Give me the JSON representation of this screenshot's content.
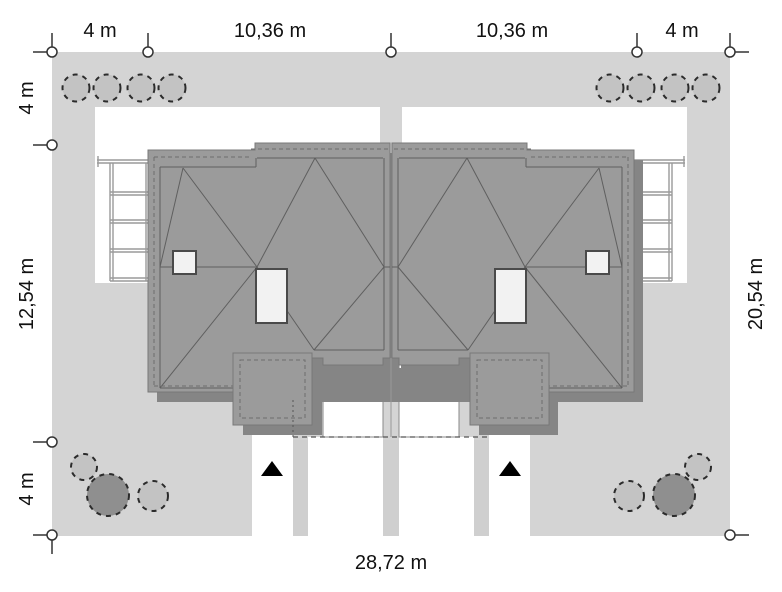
{
  "drawing": {
    "type": "site-plan",
    "description": "Roof-view plot plan of a twin (duplex) house with dimension chains, driveways, entrance arrows and garden shrubs",
    "dimensions": {
      "top": [
        "4 m",
        "10,36 m",
        "10,36 m",
        "4 m"
      ],
      "left": [
        "4 m",
        "12,54 m",
        "4 m"
      ],
      "right": [
        "20,54 m"
      ],
      "bottom": [
        "28,72 m"
      ]
    },
    "icons": {
      "dimension_marker": "survey-point-circle",
      "entrance_arrow": "black-triangle-up",
      "tree": "scalloped-shrub-circle"
    },
    "colors": {
      "plot": "#d4d4d4",
      "paving": "#ffffff",
      "path_strip": "#cfcfcf",
      "roof": "#9b9b9b",
      "roof_shadow": "#858585",
      "roof_line": "#5f5f5f",
      "roof_edge": "#787878",
      "dashed_line": "#6e6e6e",
      "chimney": "#f2f2f2",
      "chimney_border": "#4a4a4a",
      "forecourt_line": "#8a8a8a",
      "pergola_line": "#9a9a9a",
      "tree_light": "#c3c3c3",
      "tree_dark": "#8f8f8f",
      "tree_outline": "#2b2b2b",
      "marker": "#333333",
      "label_text": "#111111",
      "entrance_arrow": "#000000"
    }
  }
}
